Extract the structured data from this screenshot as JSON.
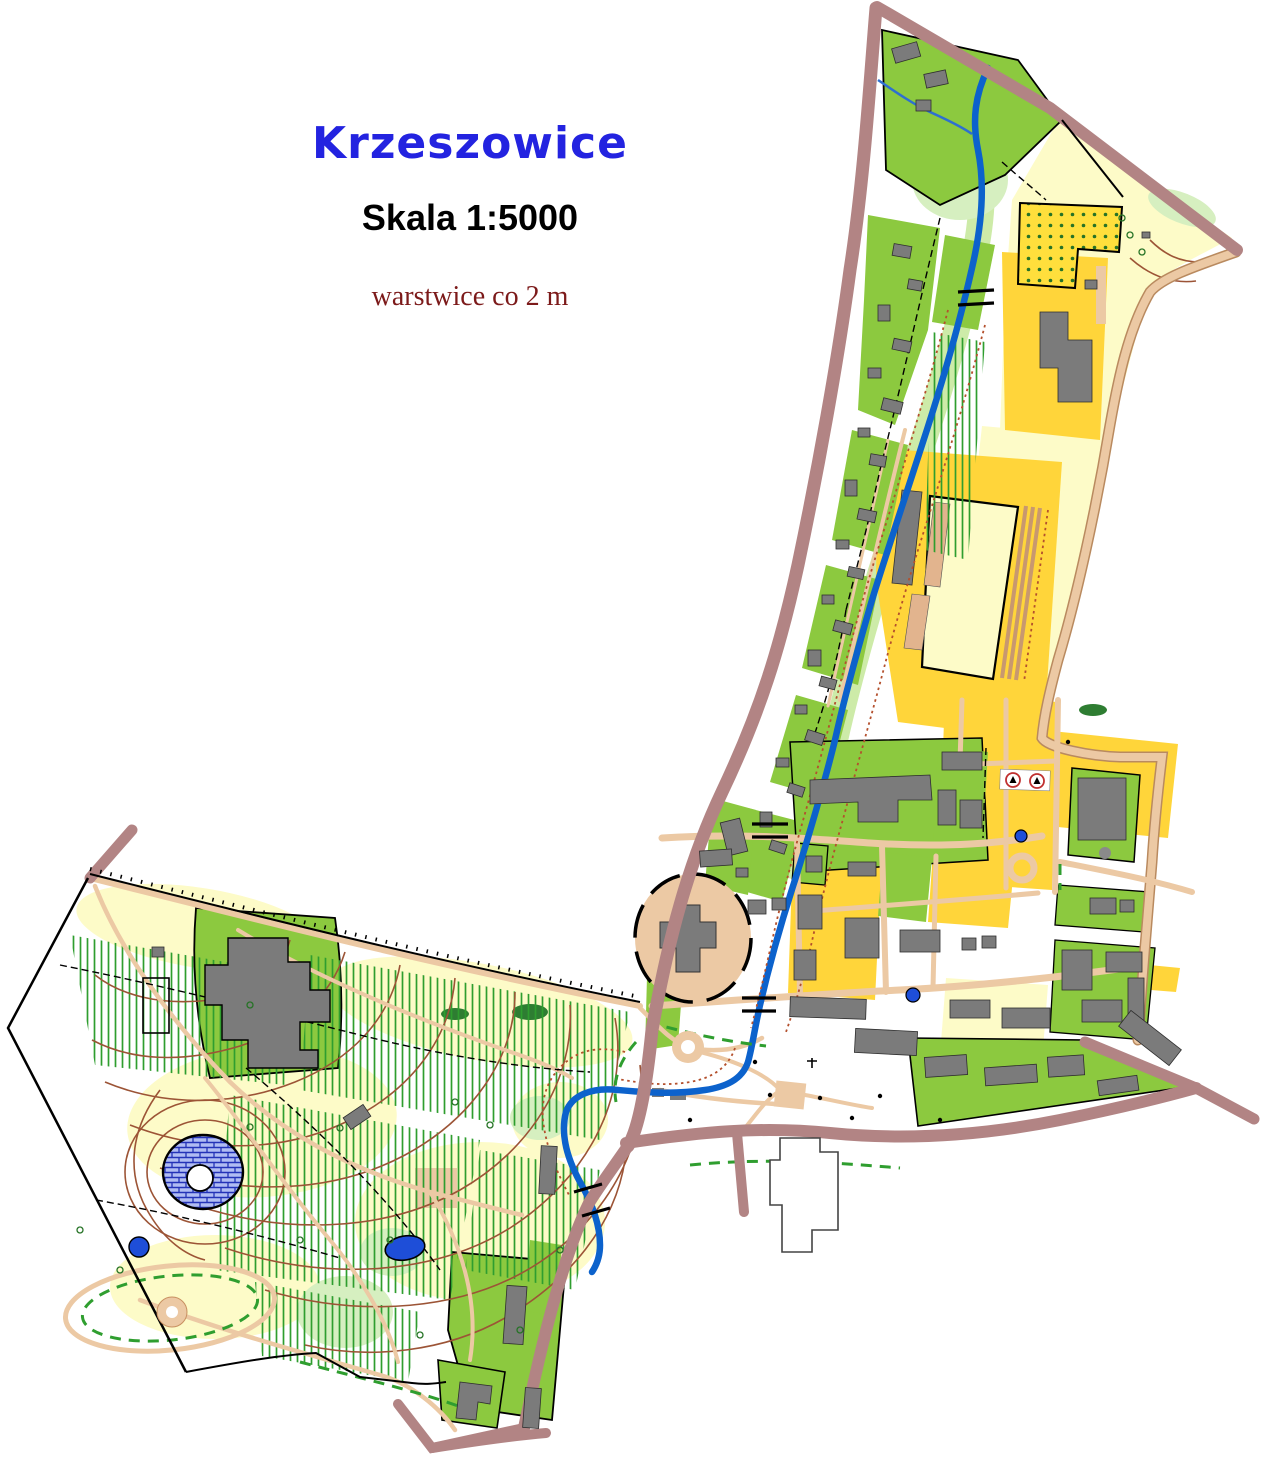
{
  "title": {
    "name": "Krzeszowice",
    "scale": "Skala 1:5000",
    "contour_note": "warstwice  co 2 m"
  },
  "map": {
    "type": "orienteering-city-sprint-map",
    "place": "Krzeszowice",
    "scale_ratio": "1:5000",
    "contour_interval_m": 2
  },
  "palette": {
    "title_blue": "#2323e0",
    "scale_black": "#000000",
    "note_dark_red": "#7c1a1a",
    "forest_green": "#8cc93f",
    "pale_green": "#d6efc0",
    "river_ribbon_green": "#cdeba8",
    "open_yellow": "#ffd53a",
    "rough_open_pale_yellow": "#fdfbc8",
    "building_gray": "#7b7b7b",
    "road_tan": "#ecc9a4",
    "major_road_rosy": "#b28484",
    "river_blue": "#0c62cc",
    "pond_blue": "#1e4ed8",
    "contour_brown": "#9c5436",
    "vegetation_stripe_green": "#2f9e2f",
    "orchard_dot_green": "#267326",
    "outline_black": "#000000"
  }
}
